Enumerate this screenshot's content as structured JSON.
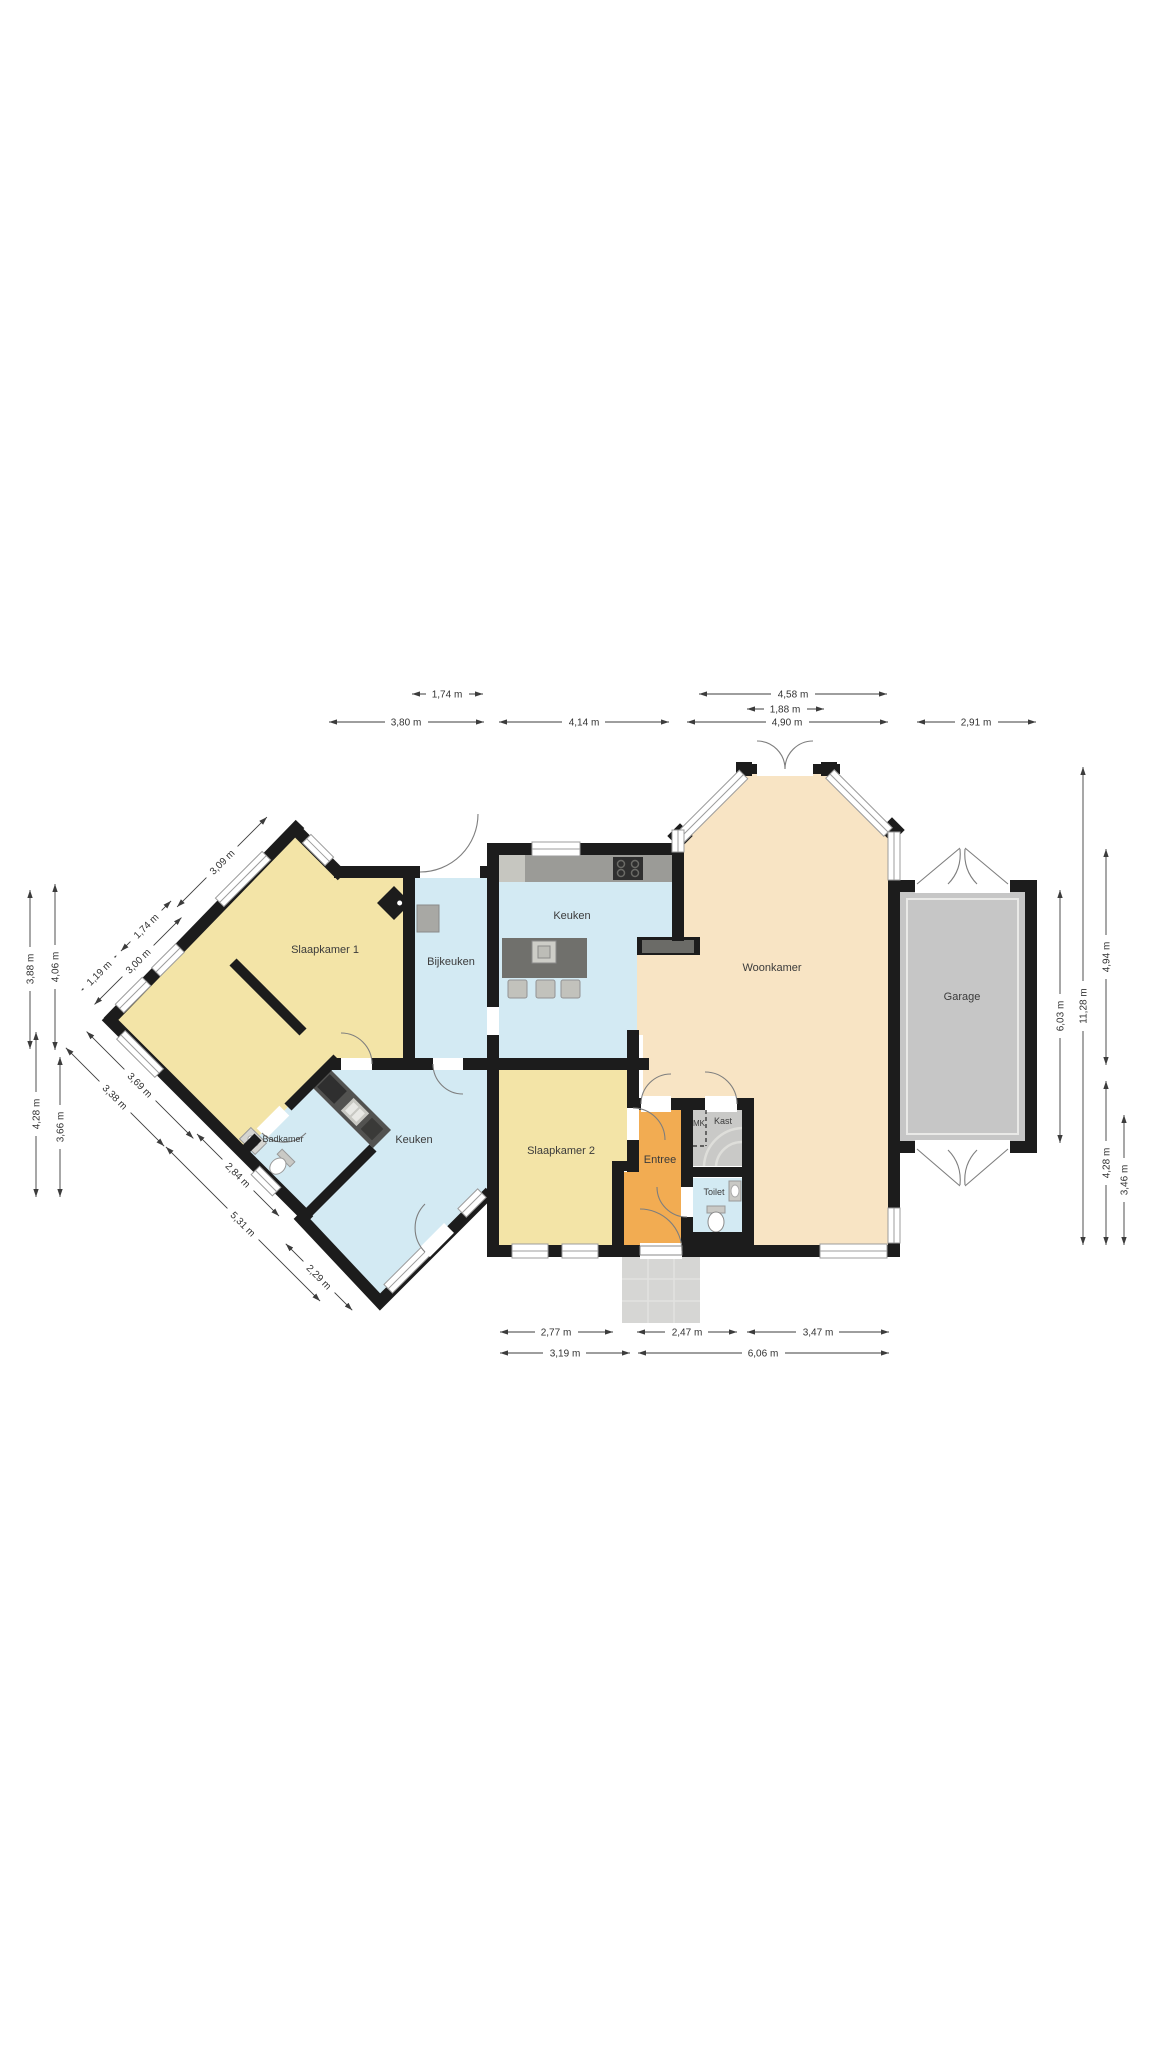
{
  "rooms": {
    "slaapkamer1": "Slaapkamer 1",
    "bijkeuken": "Bijkeuken",
    "keuken_boven": "Keuken",
    "woonkamer": "Woonkamer",
    "garage": "Garage",
    "badkamer": "Badkamer",
    "keuken": "Keuken",
    "slaapkamer2": "Slaapkamer 2",
    "entree": "Entree",
    "mk": "MK",
    "kast": "Kast",
    "toilet": "Toilet"
  },
  "dim_labels": {
    "top": [
      "1,74 m",
      "4,58 m",
      "1,88 m",
      "3,80 m",
      "4,14 m",
      "4,90 m",
      "2,91 m"
    ],
    "bottom": [
      "2,77 m",
      "2,47 m",
      "3,47 m",
      "3,19 m",
      "6,06 m"
    ],
    "left": [
      "3,88 m",
      "4,06 m",
      "4,28 m",
      "3,66 m"
    ],
    "right": [
      "6,03 m",
      "11,28 m",
      "4,94 m",
      "4,28 m",
      "3,46 m"
    ],
    "diagonal": [
      "3,09 m",
      "1,74 m",
      "3,00 m",
      "1,19 m",
      "3,69 m",
      "3,38 m",
      "2,84 m",
      "5,31 m",
      "2,29 m"
    ]
  },
  "colors": {
    "bedroom_yellow": "#F3E4A7",
    "kitchen_blue": "#D3EAF3",
    "living_peach": "#F8E4C4",
    "entree_orange": "#F2AC52",
    "garage_gray": "#C6C6C6",
    "porch_gray": "#D6D6D4",
    "wall_black": "#1C1C1C"
  }
}
